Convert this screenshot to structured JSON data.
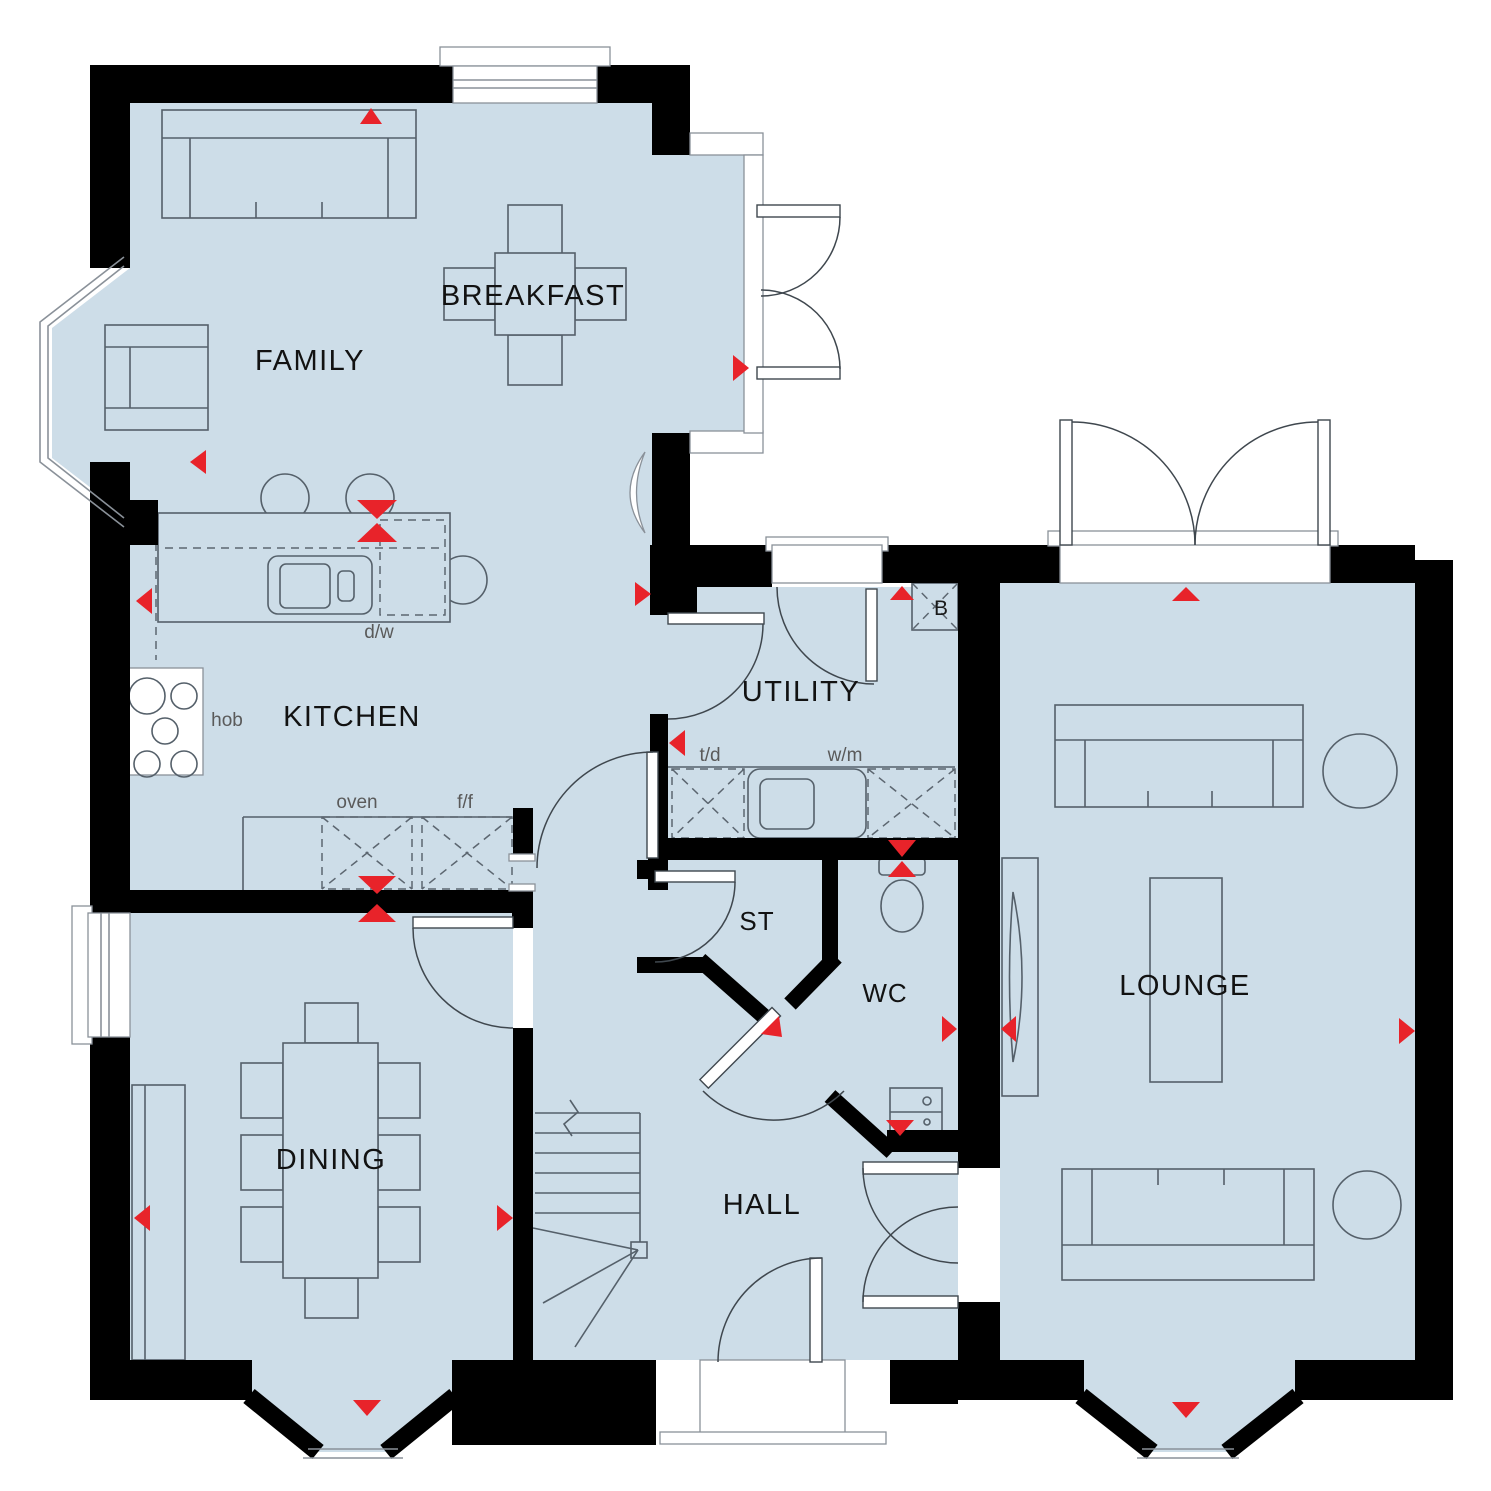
{
  "plan_title": "Ground floor plan",
  "colors": {
    "room_fill": "#cddde8",
    "wall": "#000000",
    "accent_red": "#e8232a",
    "furniture_line": "#55606a",
    "frame_line": "#8a9199",
    "label_dark": "#121212",
    "label_muted": "#5a5a5a"
  },
  "rooms": {
    "family": {
      "label": "FAMILY"
    },
    "breakfast": {
      "label": "BREAKFAST"
    },
    "kitchen": {
      "label": "KITCHEN"
    },
    "utility": {
      "label": "UTILITY"
    },
    "lounge": {
      "label": "LOUNGE"
    },
    "dining": {
      "label": "DINING"
    },
    "hall": {
      "label": "HALL"
    },
    "store": {
      "label": "ST"
    },
    "wc": {
      "label": "WC"
    }
  },
  "appliances": {
    "hob": {
      "label": "hob"
    },
    "oven": {
      "label": "oven"
    },
    "fridge_freezer": {
      "label": "f/f"
    },
    "dishwasher": {
      "label": "d/w"
    },
    "tumble_dryer": {
      "label": "t/d"
    },
    "washing_machine": {
      "label": "w/m"
    },
    "boiler": {
      "label": "B"
    }
  }
}
